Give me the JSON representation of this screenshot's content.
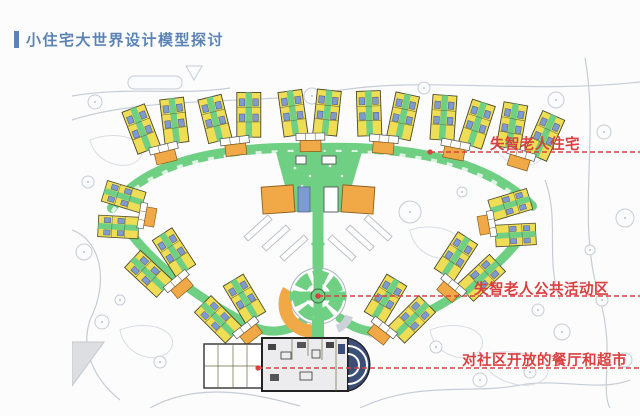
{
  "slide": {
    "title": "小住宅大世界设计模型探讨"
  },
  "annotations": [
    {
      "label": "失智老人住宅"
    },
    {
      "label": "失智老人公共活动区"
    },
    {
      "label": "对社区开放的餐厅和超市"
    }
  ],
  "colors": {
    "title_blue": "#5b84b5",
    "annotation_red": "#d9403f",
    "building_yellow": "#eedd55",
    "corridor_green": "#6fcf82",
    "furniture_blue": "#7e9bd1",
    "accent_orange": "#f0a946",
    "context_gray": "#c6ccd6"
  }
}
